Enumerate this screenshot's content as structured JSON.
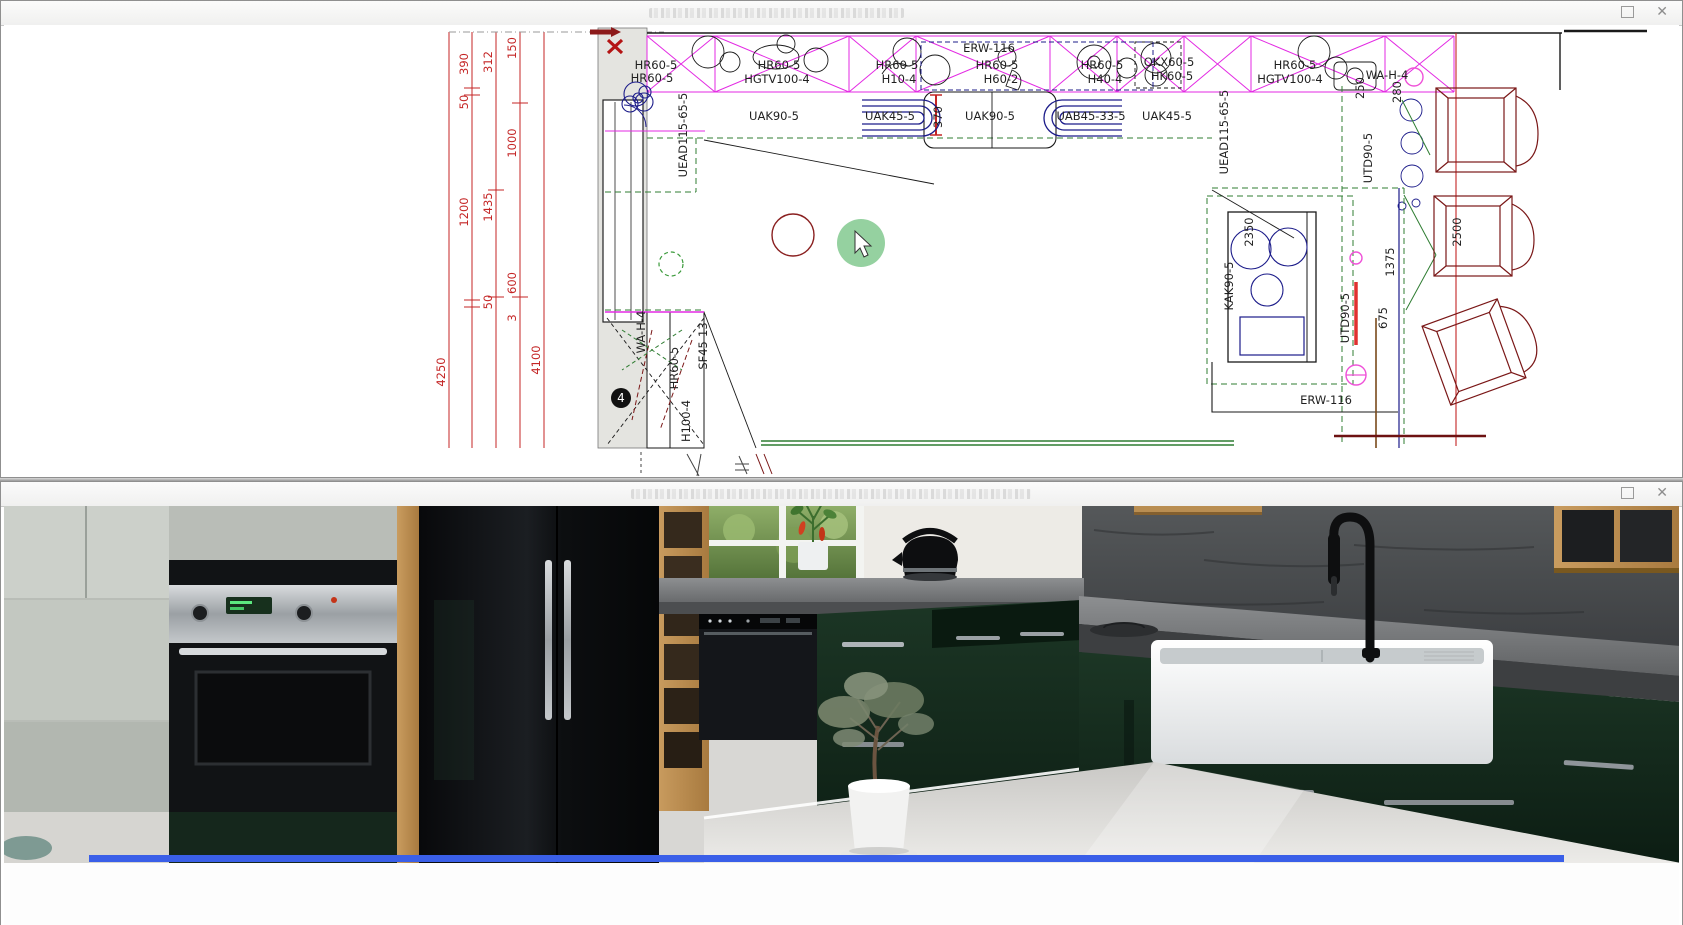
{
  "plan_window": {
    "controls": {
      "close_glyph": "✕"
    },
    "plan": {
      "accent_colors": {
        "dimension_red": "#c42525",
        "cabinet_magenta": "#e32ae3",
        "worktop_green": "#2f7d32",
        "appliance_navy": "#1c1c8a",
        "chair_darkred": "#7a1717"
      },
      "badge": {
        "number": "4"
      },
      "labels": [
        {
          "t": "HR60-5",
          "x": 652,
          "y": 69
        },
        {
          "t": "HR60-5",
          "x": 648,
          "y": 82
        },
        {
          "t": "HR60-5",
          "x": 775,
          "y": 69
        },
        {
          "t": "HGTV100-4",
          "x": 773,
          "y": 83
        },
        {
          "t": "HR60-5",
          "x": 893,
          "y": 69
        },
        {
          "t": "H10-4",
          "x": 895,
          "y": 83
        },
        {
          "t": "ERW-116",
          "x": 985,
          "y": 52
        },
        {
          "t": "HR60-5",
          "x": 993,
          "y": 69
        },
        {
          "t": "H60-2",
          "x": 997,
          "y": 83
        },
        {
          "t": "HR60-5",
          "x": 1098,
          "y": 69
        },
        {
          "t": "H40-4",
          "x": 1101,
          "y": 83
        },
        {
          "t": "OKX60-5",
          "x": 1165,
          "y": 66
        },
        {
          "t": "HK60-5",
          "x": 1168,
          "y": 80
        },
        {
          "t": "HR60-5",
          "x": 1291,
          "y": 69
        },
        {
          "t": "HGTV100-4",
          "x": 1286,
          "y": 83
        },
        {
          "t": "WA-H-4",
          "x": 1383,
          "y": 79
        },
        {
          "t": "UAK90-5",
          "x": 770,
          "y": 120
        },
        {
          "t": "UAK45-5",
          "x": 886,
          "y": 120
        },
        {
          "t": "UAK90-5",
          "x": 986,
          "y": 120
        },
        {
          "t": "UAB45-33-5",
          "x": 1087,
          "y": 120
        },
        {
          "t": "UAK45-5",
          "x": 1163,
          "y": 120
        },
        {
          "t": "ERW-116",
          "x": 1322,
          "y": 404
        },
        {
          "t": "UEAD115-65-5",
          "x": 683,
          "y": 135,
          "r": 1
        },
        {
          "t": "UEAD115-65-5",
          "x": 1224,
          "y": 132,
          "r": 1
        },
        {
          "t": "370",
          "x": 938,
          "y": 117,
          "r": 1
        },
        {
          "t": "250",
          "x": 1360,
          "y": 88,
          "r": 1
        },
        {
          "t": "280",
          "x": 1397,
          "y": 92,
          "r": 1
        },
        {
          "t": "UTD90-5",
          "x": 1368,
          "y": 158,
          "r": 1
        },
        {
          "t": "UTD90-5",
          "x": 1345,
          "y": 318,
          "r": 1
        },
        {
          "t": "675",
          "x": 1383,
          "y": 318,
          "r": 1
        },
        {
          "t": "1375",
          "x": 1390,
          "y": 262,
          "r": 1
        },
        {
          "t": "2350",
          "x": 1249,
          "y": 232,
          "r": 1
        },
        {
          "t": "KAK90-5",
          "x": 1229,
          "y": 286,
          "r": 1
        },
        {
          "t": "2500",
          "x": 1457,
          "y": 232,
          "r": 1
        },
        {
          "t": "WA-H-4",
          "x": 641,
          "y": 332,
          "r": 1
        },
        {
          "t": "SF45-13",
          "x": 703,
          "y": 346,
          "r": 1
        },
        {
          "t": "HR60-5",
          "x": 674,
          "y": 368,
          "r": 1
        },
        {
          "t": "H100-4",
          "x": 686,
          "y": 421,
          "r": 1
        },
        {
          "t": "4250",
          "x": 441,
          "y": 372,
          "r": 1,
          "c": "#c42525"
        },
        {
          "t": "390",
          "x": 464,
          "y": 64,
          "r": 1,
          "c": "#c42525"
        },
        {
          "t": "50",
          "x": 464,
          "y": 102,
          "r": 1,
          "c": "#c42525"
        },
        {
          "t": "1200",
          "x": 464,
          "y": 212,
          "r": 1,
          "c": "#c42525"
        },
        {
          "t": "312",
          "x": 488,
          "y": 62,
          "r": 1,
          "c": "#c42525"
        },
        {
          "t": "1435",
          "x": 488,
          "y": 207,
          "r": 1,
          "c": "#c42525"
        },
        {
          "t": "50",
          "x": 488,
          "y": 302,
          "r": 1,
          "c": "#c42525"
        },
        {
          "t": "3",
          "x": 512,
          "y": 318,
          "r": 1,
          "c": "#c42525"
        },
        {
          "t": "150",
          "x": 512,
          "y": 48,
          "r": 1,
          "c": "#c42525"
        },
        {
          "t": "1000",
          "x": 512,
          "y": 143,
          "r": 1,
          "c": "#c42525"
        },
        {
          "t": "600",
          "x": 512,
          "y": 283,
          "r": 1,
          "c": "#c42525"
        },
        {
          "t": "4100",
          "x": 536,
          "y": 360,
          "r": 1,
          "c": "#c42525"
        },
        {
          "t": "4",
          "x": 617,
          "y": 402,
          "c": "#ffffff",
          "fs": 12
        }
      ]
    }
  },
  "render_window": {
    "controls": {
      "close_glyph": "✕"
    },
    "scene": {
      "cabinet_green": "#13291d",
      "counter_gray": "#737577",
      "stone_wall_gray": "#3e4042",
      "selection_bar_blue": "#3a5fe8"
    }
  }
}
